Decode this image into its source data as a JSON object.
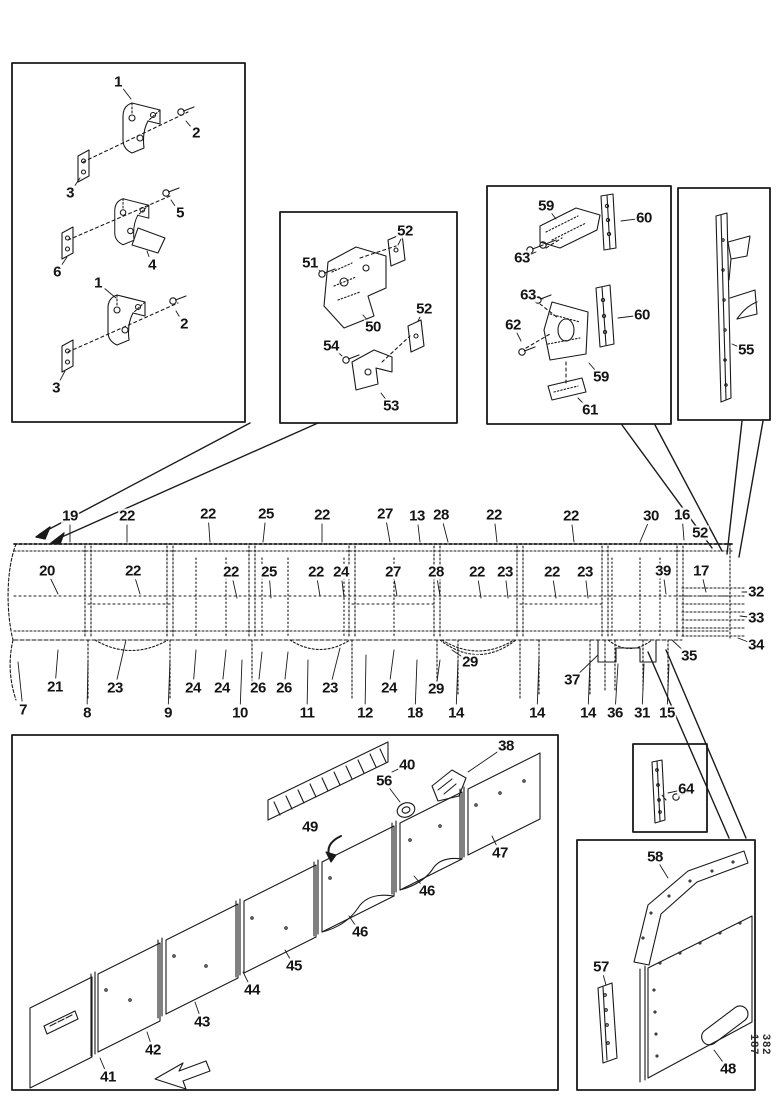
{
  "page": {
    "background": "#ffffff",
    "ink": "#1a1a1a"
  },
  "footer_code": "382 187",
  "part_labels": [
    {
      "t": "1",
      "x": 118,
      "y": 82,
      "l": [
        131,
        99
      ]
    },
    {
      "t": "2",
      "x": 196,
      "y": 133,
      "l": [
        186,
        121
      ]
    },
    {
      "t": "3",
      "x": 70,
      "y": 193,
      "l": [
        80,
        178
      ]
    },
    {
      "t": "5",
      "x": 180,
      "y": 213,
      "l": [
        171,
        200
      ]
    },
    {
      "t": "6",
      "x": 57,
      "y": 272,
      "l": [
        67,
        257
      ]
    },
    {
      "t": "4",
      "x": 152,
      "y": 265,
      "l": [
        147,
        251
      ]
    },
    {
      "t": "1",
      "x": 98,
      "y": 283,
      "l": [
        116,
        298
      ]
    },
    {
      "t": "2",
      "x": 184,
      "y": 324,
      "l": [
        176,
        311
      ]
    },
    {
      "t": "3",
      "x": 56,
      "y": 388,
      "l": [
        65,
        371
      ]
    },
    {
      "t": "52",
      "x": 405,
      "y": 231,
      "l": [
        398,
        245
      ]
    },
    {
      "t": "51",
      "x": 310,
      "y": 263,
      "l": [
        320,
        271
      ]
    },
    {
      "t": "50",
      "x": 373,
      "y": 327,
      "l": [
        363,
        315
      ]
    },
    {
      "t": "52",
      "x": 424,
      "y": 309,
      "l": [
        418,
        321
      ]
    },
    {
      "t": "54",
      "x": 331,
      "y": 346,
      "l": [
        342,
        356
      ]
    },
    {
      "t": "53",
      "x": 391,
      "y": 406,
      "l": [
        381,
        393
      ]
    },
    {
      "t": "59",
      "x": 546,
      "y": 206,
      "l": [
        556,
        219
      ]
    },
    {
      "t": "60",
      "x": 644,
      "y": 218,
      "l": [
        621,
        221
      ]
    },
    {
      "t": "63",
      "x": 522,
      "y": 258,
      "l": [
        536,
        252
      ]
    },
    {
      "t": "63",
      "x": 528,
      "y": 295,
      "l": [
        543,
        299
      ]
    },
    {
      "t": "62",
      "x": 513,
      "y": 325,
      "l": [
        521,
        341
      ]
    },
    {
      "t": "60",
      "x": 642,
      "y": 315,
      "l": [
        618,
        318
      ]
    },
    {
      "t": "59",
      "x": 601,
      "y": 377,
      "l": [
        589,
        363
      ]
    },
    {
      "t": "61",
      "x": 590,
      "y": 410,
      "l": [
        578,
        398
      ]
    },
    {
      "t": "55",
      "x": 746,
      "y": 350,
      "l": [
        732,
        344
      ]
    },
    {
      "t": "19",
      "x": 70,
      "y": 516,
      "l": [
        70,
        542
      ]
    },
    {
      "t": "22",
      "x": 127,
      "y": 516,
      "l": [
        127,
        542
      ]
    },
    {
      "t": "22",
      "x": 208,
      "y": 514,
      "l": [
        210,
        542
      ]
    },
    {
      "t": "25",
      "x": 266,
      "y": 514,
      "l": [
        263,
        542
      ]
    },
    {
      "t": "22",
      "x": 322,
      "y": 515,
      "l": [
        322,
        542
      ]
    },
    {
      "t": "27",
      "x": 385,
      "y": 514,
      "l": [
        390,
        542
      ]
    },
    {
      "t": "13",
      "x": 417,
      "y": 516,
      "l": [
        420,
        542
      ]
    },
    {
      "t": "28",
      "x": 441,
      "y": 515,
      "l": [
        448,
        542
      ]
    },
    {
      "t": "22",
      "x": 494,
      "y": 515,
      "l": [
        497,
        542
      ]
    },
    {
      "t": "22",
      "x": 571,
      "y": 516,
      "l": [
        574,
        542
      ]
    },
    {
      "t": "30",
      "x": 651,
      "y": 516,
      "l": [
        640,
        542
      ]
    },
    {
      "t": "16",
      "x": 682,
      "y": 515,
      "l": [
        684,
        540
      ]
    },
    {
      "t": "52",
      "x": 700,
      "y": 533
    },
    {
      "t": "20",
      "x": 47,
      "y": 571,
      "l": [
        58,
        594
      ]
    },
    {
      "t": "22",
      "x": 133,
      "y": 571,
      "l": [
        140,
        594
      ]
    },
    {
      "t": "22",
      "x": 231,
      "y": 572,
      "l": [
        237,
        598
      ]
    },
    {
      "t": "25",
      "x": 269,
      "y": 572,
      "l": [
        271,
        598
      ]
    },
    {
      "t": "22",
      "x": 316,
      "y": 572,
      "l": [
        320,
        596
      ]
    },
    {
      "t": "24",
      "x": 341,
      "y": 572,
      "l": [
        344,
        598
      ]
    },
    {
      "t": "27",
      "x": 393,
      "y": 572,
      "l": [
        397,
        596
      ]
    },
    {
      "t": "28",
      "x": 436,
      "y": 572,
      "l": [
        440,
        596
      ]
    },
    {
      "t": "22",
      "x": 477,
      "y": 572,
      "l": [
        481,
        598
      ]
    },
    {
      "t": "23",
      "x": 505,
      "y": 572,
      "l": [
        508,
        598
      ]
    },
    {
      "t": "22",
      "x": 552,
      "y": 572,
      "l": [
        556,
        598
      ]
    },
    {
      "t": "23",
      "x": 585,
      "y": 572,
      "l": [
        588,
        598
      ]
    },
    {
      "t": "39",
      "x": 663,
      "y": 571,
      "l": [
        666,
        594
      ]
    },
    {
      "t": "17",
      "x": 701,
      "y": 571,
      "l": [
        706,
        592
      ]
    },
    {
      "t": "32",
      "x": 756,
      "y": 592,
      "l": [
        742,
        592
      ]
    },
    {
      "t": "33",
      "x": 756,
      "y": 618,
      "l": [
        740,
        616
      ]
    },
    {
      "t": "34",
      "x": 756,
      "y": 645,
      "l": [
        738,
        638
      ]
    },
    {
      "t": "21",
      "x": 55,
      "y": 687,
      "l": [
        58,
        650
      ]
    },
    {
      "t": "23",
      "x": 115,
      "y": 688,
      "l": [
        126,
        640
      ]
    },
    {
      "t": "24",
      "x": 193,
      "y": 688,
      "l": [
        196,
        650
      ]
    },
    {
      "t": "24",
      "x": 222,
      "y": 688,
      "l": [
        226,
        650
      ]
    },
    {
      "t": "26",
      "x": 258,
      "y": 688,
      "l": [
        262,
        652
      ]
    },
    {
      "t": "26",
      "x": 284,
      "y": 688,
      "l": [
        288,
        652
      ]
    },
    {
      "t": "23",
      "x": 330,
      "y": 688,
      "l": [
        340,
        648
      ]
    },
    {
      "t": "24",
      "x": 389,
      "y": 688,
      "l": [
        394,
        650
      ]
    },
    {
      "t": "29",
      "x": 436,
      "y": 689,
      "l": [
        440,
        660
      ]
    },
    {
      "t": "29",
      "x": 470,
      "y": 662,
      "l": [
        452,
        650
      ]
    },
    {
      "t": "37",
      "x": 572,
      "y": 680,
      "l": [
        598,
        655
      ]
    },
    {
      "t": "35",
      "x": 689,
      "y": 656,
      "l": [
        672,
        640
      ]
    },
    {
      "t": "7",
      "x": 23,
      "y": 710,
      "l": [
        18,
        662
      ]
    },
    {
      "t": "8",
      "x": 87,
      "y": 713,
      "l": [
        88,
        660
      ]
    },
    {
      "t": "9",
      "x": 168,
      "y": 713,
      "l": [
        170,
        660
      ]
    },
    {
      "t": "10",
      "x": 240,
      "y": 713,
      "l": [
        242,
        660
      ]
    },
    {
      "t": "11",
      "x": 307,
      "y": 713,
      "l": [
        308,
        660
      ]
    },
    {
      "t": "12",
      "x": 365,
      "y": 713,
      "l": [
        366,
        655
      ]
    },
    {
      "t": "18",
      "x": 415,
      "y": 713,
      "l": [
        417,
        660
      ]
    },
    {
      "t": "14",
      "x": 456,
      "y": 713,
      "l": [
        458,
        660
      ]
    },
    {
      "t": "14",
      "x": 537,
      "y": 713,
      "l": [
        539,
        658
      ]
    },
    {
      "t": "14",
      "x": 588,
      "y": 713,
      "l": [
        590,
        660
      ]
    },
    {
      "t": "36",
      "x": 615,
      "y": 713,
      "l": [
        618,
        664
      ]
    },
    {
      "t": "31",
      "x": 642,
      "y": 713,
      "l": [
        644,
        664
      ]
    },
    {
      "t": "15",
      "x": 667,
      "y": 713,
      "l": [
        669,
        664
      ]
    },
    {
      "t": "38",
      "x": 506,
      "y": 746,
      "l": [
        468,
        772
      ]
    },
    {
      "t": "40",
      "x": 407,
      "y": 765,
      "l": [
        392,
        772
      ]
    },
    {
      "t": "56",
      "x": 384,
      "y": 781,
      "l": [
        400,
        802
      ]
    },
    {
      "t": "49",
      "x": 310,
      "y": 827
    },
    {
      "t": "47",
      "x": 500,
      "y": 853,
      "l": [
        492,
        836
      ]
    },
    {
      "t": "46",
      "x": 427,
      "y": 891,
      "l": [
        414,
        876
      ]
    },
    {
      "t": "46",
      "x": 360,
      "y": 932,
      "l": [
        349,
        916
      ]
    },
    {
      "t": "45",
      "x": 294,
      "y": 966,
      "l": [
        285,
        950
      ]
    },
    {
      "t": "44",
      "x": 252,
      "y": 990,
      "l": [
        243,
        972
      ]
    },
    {
      "t": "43",
      "x": 202,
      "y": 1022,
      "l": [
        195,
        1002
      ]
    },
    {
      "t": "42",
      "x": 153,
      "y": 1050,
      "l": [
        147,
        1032
      ]
    },
    {
      "t": "41",
      "x": 108,
      "y": 1077,
      "l": [
        100,
        1058
      ]
    },
    {
      "t": "64",
      "x": 686,
      "y": 789,
      "l": [
        668,
        793
      ]
    },
    {
      "t": "58",
      "x": 655,
      "y": 857,
      "l": [
        668,
        878
      ]
    },
    {
      "t": "57",
      "x": 601,
      "y": 967,
      "l": [
        606,
        985
      ]
    },
    {
      "t": "48",
      "x": 728,
      "y": 1069,
      "l": [
        714,
        1050
      ]
    }
  ]
}
